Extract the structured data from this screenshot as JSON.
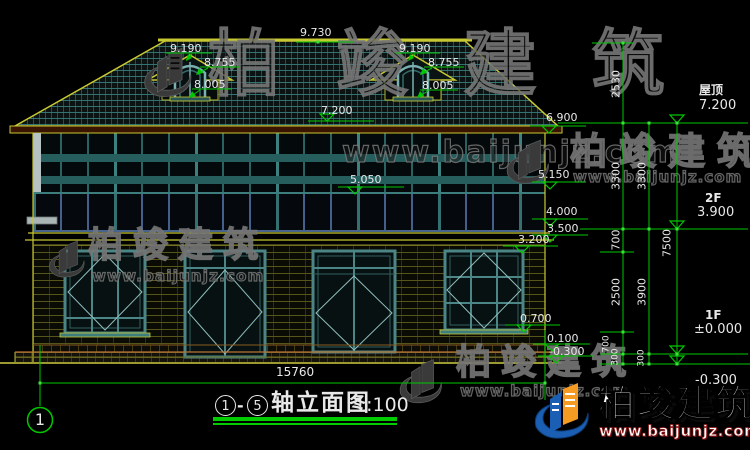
{
  "drawing": {
    "elevation_marks": {
      "ridge": "9.730",
      "dormer_left": {
        "top": "9.190",
        "eave": "8.755",
        "base": "8.005"
      },
      "dormer_right": {
        "top": "9.190",
        "eave": "8.755",
        "base": "8.005"
      },
      "roof_surface": "7.200",
      "eave_right": "6.900",
      "band_right": "5.150",
      "band_mid": "5.050",
      "m4000": "4.000",
      "m3500": "3.500",
      "m3200": "3.200",
      "m0700": "0.700",
      "m0100": "0.100",
      "mneg0300": "-0.300"
    },
    "dimensions": {
      "col_inner": [
        "2530",
        "3300",
        "700",
        "2500",
        "700",
        "300"
      ],
      "col_mid": [
        "3300",
        "3900",
        "300"
      ],
      "col_outer": [
        "7500"
      ],
      "width": "15760"
    },
    "floor_levels": {
      "roof": {
        "label": "屋顶",
        "value": "7.200"
      },
      "f2": {
        "label": "2F",
        "value": "3.900"
      },
      "f1": {
        "label": "1F",
        "value": "±0.000"
      },
      "ground": {
        "value": "-0.300"
      }
    },
    "axis": {
      "bubble": "1"
    },
    "title": {
      "axis_from": "1",
      "separator": "-",
      "axis_to": "5",
      "name": "轴立面图",
      "scale": "1:100"
    }
  },
  "watermark": {
    "brand": "柏竣建筑",
    "site": "www.baijunjz.com"
  },
  "footer": {
    "brand": "柏竣建筑",
    "site": "www.baijunjz.com"
  },
  "colors": {
    "dim_green": "#00c800",
    "line_yellow": "#c8c832",
    "frame_teal": "#4b8585",
    "logo_blue": "#1a5fb4",
    "logo_orange": "#f59a23"
  }
}
